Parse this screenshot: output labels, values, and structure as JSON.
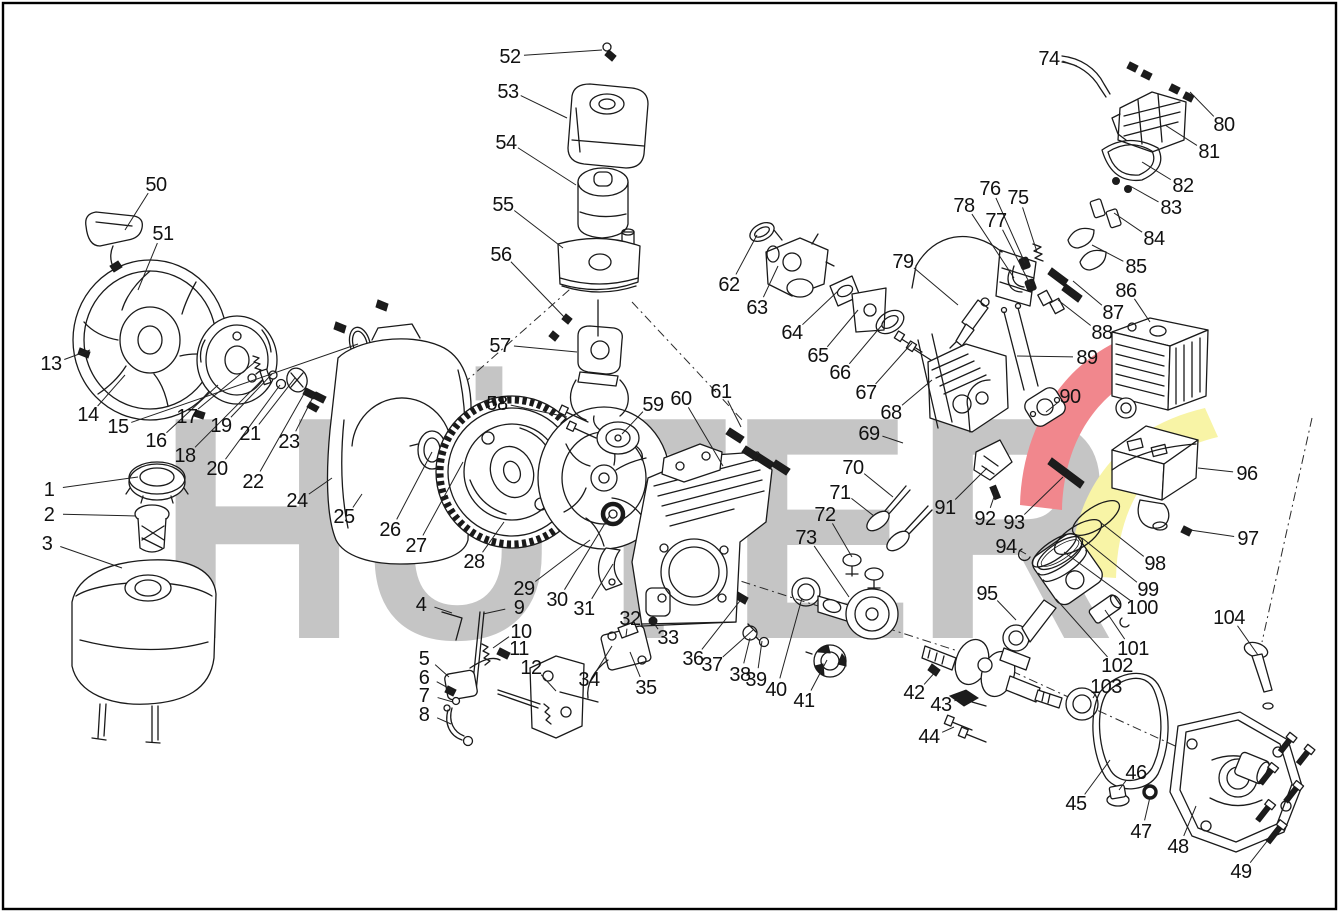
{
  "meta": {
    "title": "Engine exploded-view spare parts diagram",
    "parts_count": 104
  },
  "watermark": {
    "text": "HÜTER",
    "text_color": "#c5c5c5",
    "swoosh_red": "#f1878d",
    "swoosh_yellow": "#f8f4a6"
  },
  "style": {
    "line_color": "#1a1a1a",
    "label_color": "#111111",
    "background": "#ffffff"
  },
  "callouts": [
    {
      "n": "1",
      "lx": 49,
      "ly": 489,
      "tx": 138,
      "ty": 477
    },
    {
      "n": "2",
      "lx": 49,
      "ly": 514,
      "tx": 136,
      "ty": 516
    },
    {
      "n": "3",
      "lx": 47,
      "ly": 543,
      "tx": 122,
      "ty": 568
    },
    {
      "n": "4",
      "lx": 421,
      "ly": 604,
      "tx": 452,
      "ty": 613
    },
    {
      "n": "5",
      "lx": 424,
      "ly": 658,
      "tx": 449,
      "ty": 677
    },
    {
      "n": "6",
      "lx": 424,
      "ly": 677,
      "tx": 452,
      "ty": 690
    },
    {
      "n": "7",
      "lx": 424,
      "ly": 695,
      "tx": 453,
      "ty": 702
    },
    {
      "n": "8",
      "lx": 424,
      "ly": 714,
      "tx": 451,
      "ty": 724
    },
    {
      "n": "9",
      "lx": 519,
      "ly": 607,
      "tx": 483,
      "ty": 614
    },
    {
      "n": "10",
      "lx": 521,
      "ly": 631,
      "tx": 493,
      "ty": 648
    },
    {
      "n": "11",
      "lx": 519,
      "ly": 648,
      "tx": 506,
      "ty": 653
    },
    {
      "n": "12",
      "lx": 531,
      "ly": 667,
      "tx": 556,
      "ty": 691
    },
    {
      "n": "13",
      "lx": 51,
      "ly": 363,
      "tx": 90,
      "ty": 350
    },
    {
      "n": "14",
      "lx": 88,
      "ly": 414,
      "tx": 125,
      "ty": 375
    },
    {
      "n": "15",
      "lx": 118,
      "ly": 426,
      "tx": 358,
      "ty": 344
    },
    {
      "n": "16",
      "lx": 156,
      "ly": 440,
      "tx": 218,
      "ty": 385
    },
    {
      "n": "17",
      "lx": 187,
      "ly": 416,
      "tx": 255,
      "ty": 362
    },
    {
      "n": "18",
      "lx": 185,
      "ly": 455,
      "tx": 262,
      "ty": 380
    },
    {
      "n": "19",
      "lx": 221,
      "ly": 425,
      "tx": 272,
      "ty": 374
    },
    {
      "n": "20",
      "lx": 217,
      "ly": 468,
      "tx": 280,
      "ty": 385
    },
    {
      "n": "21",
      "lx": 250,
      "ly": 433,
      "tx": 295,
      "ty": 378
    },
    {
      "n": "22",
      "lx": 253,
      "ly": 481,
      "tx": 305,
      "ty": 392
    },
    {
      "n": "23",
      "lx": 289,
      "ly": 441,
      "tx": 314,
      "ty": 395
    },
    {
      "n": "24",
      "lx": 297,
      "ly": 500,
      "tx": 332,
      "ty": 478
    },
    {
      "n": "25",
      "lx": 344,
      "ly": 516,
      "tx": 362,
      "ty": 494
    },
    {
      "n": "26",
      "lx": 390,
      "ly": 529,
      "tx": 432,
      "ty": 452
    },
    {
      "n": "27",
      "lx": 416,
      "ly": 545,
      "tx": 463,
      "ty": 462
    },
    {
      "n": "28",
      "lx": 474,
      "ly": 561,
      "tx": 504,
      "ty": 522
    },
    {
      "n": "29",
      "lx": 524,
      "ly": 588,
      "tx": 590,
      "ty": 540
    },
    {
      "n": "30",
      "lx": 557,
      "ly": 599,
      "tx": 610,
      "ty": 515
    },
    {
      "n": "31",
      "lx": 584,
      "ly": 608,
      "tx": 613,
      "ty": 564
    },
    {
      "n": "32",
      "lx": 630,
      "ly": 618,
      "tx": 626,
      "ty": 636
    },
    {
      "n": "33",
      "lx": 668,
      "ly": 637,
      "tx": 653,
      "ty": 622
    },
    {
      "n": "34",
      "lx": 589,
      "ly": 679,
      "tx": 612,
      "ty": 646
    },
    {
      "n": "35",
      "lx": 646,
      "ly": 687,
      "tx": 630,
      "ty": 652
    },
    {
      "n": "36",
      "lx": 693,
      "ly": 658,
      "tx": 743,
      "ty": 597
    },
    {
      "n": "37",
      "lx": 712,
      "ly": 664,
      "tx": 753,
      "ty": 630
    },
    {
      "n": "38",
      "lx": 740,
      "ly": 674,
      "tx": 750,
      "ty": 638
    },
    {
      "n": "39",
      "lx": 756,
      "ly": 679,
      "tx": 762,
      "ty": 641
    },
    {
      "n": "40",
      "lx": 776,
      "ly": 689,
      "tx": 802,
      "ty": 598
    },
    {
      "n": "41",
      "lx": 804,
      "ly": 700,
      "tx": 827,
      "ty": 660
    },
    {
      "n": "42",
      "lx": 914,
      "ly": 692,
      "tx": 937,
      "ty": 670
    },
    {
      "n": "43",
      "lx": 941,
      "ly": 704,
      "tx": 958,
      "ty": 699
    },
    {
      "n": "44",
      "lx": 929,
      "ly": 736,
      "tx": 954,
      "ty": 727
    },
    {
      "n": "45",
      "lx": 1076,
      "ly": 803,
      "tx": 1110,
      "ty": 760
    },
    {
      "n": "46",
      "lx": 1136,
      "ly": 772,
      "tx": 1119,
      "ty": 790
    },
    {
      "n": "47",
      "lx": 1141,
      "ly": 831,
      "tx": 1150,
      "ty": 797
    },
    {
      "n": "48",
      "lx": 1178,
      "ly": 846,
      "tx": 1196,
      "ty": 806
    },
    {
      "n": "49",
      "lx": 1241,
      "ly": 871,
      "tx": 1268,
      "ty": 840
    },
    {
      "n": "50",
      "lx": 156,
      "ly": 184,
      "tx": 125,
      "ty": 230
    },
    {
      "n": "51",
      "lx": 163,
      "ly": 233,
      "tx": 138,
      "ty": 290
    },
    {
      "n": "52",
      "lx": 510,
      "ly": 56,
      "tx": 602,
      "ty": 50
    },
    {
      "n": "53",
      "lx": 508,
      "ly": 91,
      "tx": 567,
      "ty": 118
    },
    {
      "n": "54",
      "lx": 506,
      "ly": 142,
      "tx": 576,
      "ty": 185
    },
    {
      "n": "55",
      "lx": 503,
      "ly": 204,
      "tx": 563,
      "ty": 248
    },
    {
      "n": "56",
      "lx": 501,
      "ly": 254,
      "tx": 567,
      "ty": 320
    },
    {
      "n": "57",
      "lx": 500,
      "ly": 345,
      "tx": 577,
      "ty": 352
    },
    {
      "n": "58",
      "lx": 497,
      "ly": 403,
      "tx": 567,
      "ty": 417
    },
    {
      "n": "59",
      "lx": 653,
      "ly": 404,
      "tx": 622,
      "ty": 434
    },
    {
      "n": "60",
      "lx": 681,
      "ly": 398,
      "tx": 723,
      "ty": 466
    },
    {
      "n": "61",
      "lx": 721,
      "ly": 391,
      "tx": 741,
      "ty": 427
    },
    {
      "n": "62",
      "lx": 729,
      "ly": 284,
      "tx": 757,
      "ty": 235
    },
    {
      "n": "63",
      "lx": 757,
      "ly": 307,
      "tx": 778,
      "ty": 266
    },
    {
      "n": "64",
      "lx": 792,
      "ly": 332,
      "tx": 838,
      "ty": 291
    },
    {
      "n": "65",
      "lx": 818,
      "ly": 355,
      "tx": 858,
      "ty": 310
    },
    {
      "n": "66",
      "lx": 840,
      "ly": 372,
      "tx": 882,
      "ty": 325
    },
    {
      "n": "67",
      "lx": 866,
      "ly": 392,
      "tx": 912,
      "ty": 343
    },
    {
      "n": "68",
      "lx": 891,
      "ly": 412,
      "tx": 932,
      "ty": 380
    },
    {
      "n": "69",
      "lx": 869,
      "ly": 433,
      "tx": 903,
      "ty": 443
    },
    {
      "n": "70",
      "lx": 853,
      "ly": 467,
      "tx": 893,
      "ty": 497
    },
    {
      "n": "71",
      "lx": 840,
      "ly": 492,
      "tx": 874,
      "ty": 516
    },
    {
      "n": "72",
      "lx": 825,
      "ly": 514,
      "tx": 852,
      "ty": 557
    },
    {
      "n": "73",
      "lx": 806,
      "ly": 537,
      "tx": 849,
      "ty": 597
    },
    {
      "n": "74",
      "lx": 1049,
      "ly": 58,
      "tx": 1077,
      "ty": 66
    },
    {
      "n": "75",
      "lx": 1018,
      "ly": 197,
      "tx": 1037,
      "ty": 252
    },
    {
      "n": "76",
      "lx": 990,
      "ly": 188,
      "tx": 1025,
      "ty": 263
    },
    {
      "n": "77",
      "lx": 996,
      "ly": 220,
      "tx": 1031,
      "ty": 286
    },
    {
      "n": "78",
      "lx": 964,
      "ly": 205,
      "tx": 1014,
      "ty": 278
    },
    {
      "n": "79",
      "lx": 903,
      "ly": 261,
      "tx": 958,
      "ty": 305
    },
    {
      "n": "80",
      "lx": 1224,
      "ly": 124,
      "tx": 1190,
      "ty": 92
    },
    {
      "n": "81",
      "lx": 1209,
      "ly": 151,
      "tx": 1165,
      "ty": 125
    },
    {
      "n": "82",
      "lx": 1183,
      "ly": 185,
      "tx": 1142,
      "ty": 162
    },
    {
      "n": "83",
      "lx": 1171,
      "ly": 207,
      "tx": 1130,
      "ty": 186
    },
    {
      "n": "84",
      "lx": 1154,
      "ly": 238,
      "tx": 1114,
      "ty": 213
    },
    {
      "n": "85",
      "lx": 1136,
      "ly": 266,
      "tx": 1092,
      "ty": 245
    },
    {
      "n": "86",
      "lx": 1126,
      "ly": 290,
      "tx": 1150,
      "ty": 322
    },
    {
      "n": "87",
      "lx": 1113,
      "ly": 312,
      "tx": 1073,
      "ty": 281
    },
    {
      "n": "88",
      "lx": 1102,
      "ly": 332,
      "tx": 1058,
      "ty": 300
    },
    {
      "n": "89",
      "lx": 1087,
      "ly": 357,
      "tx": 1017,
      "ty": 356
    },
    {
      "n": "90",
      "lx": 1070,
      "ly": 396,
      "tx": 1046,
      "ty": 412
    },
    {
      "n": "91",
      "lx": 945,
      "ly": 507,
      "tx": 987,
      "ty": 468
    },
    {
      "n": "92",
      "lx": 985,
      "ly": 518,
      "tx": 996,
      "ty": 491
    },
    {
      "n": "93",
      "lx": 1014,
      "ly": 522,
      "tx": 1063,
      "ty": 477
    },
    {
      "n": "94",
      "lx": 1006,
      "ly": 546,
      "tx": 1026,
      "ty": 554
    },
    {
      "n": "95",
      "lx": 987,
      "ly": 593,
      "tx": 1016,
      "ty": 620
    },
    {
      "n": "96",
      "lx": 1247,
      "ly": 473,
      "tx": 1198,
      "ty": 468
    },
    {
      "n": "97",
      "lx": 1248,
      "ly": 538,
      "tx": 1190,
      "ty": 530
    },
    {
      "n": "98",
      "lx": 1155,
      "ly": 563,
      "tx": 1100,
      "ty": 522
    },
    {
      "n": "99",
      "lx": 1148,
      "ly": 589,
      "tx": 1082,
      "ty": 538
    },
    {
      "n": "100",
      "lx": 1142,
      "ly": 607,
      "tx": 1064,
      "ty": 552
    },
    {
      "n": "101",
      "lx": 1133,
      "ly": 648,
      "tx": 1105,
      "ty": 610
    },
    {
      "n": "102",
      "lx": 1117,
      "ly": 665,
      "tx": 1056,
      "ty": 599
    },
    {
      "n": "103",
      "lx": 1106,
      "ly": 686,
      "tx": 1093,
      "ty": 698
    },
    {
      "n": "104",
      "lx": 1229,
      "ly": 617,
      "tx": 1258,
      "ty": 655
    }
  ]
}
